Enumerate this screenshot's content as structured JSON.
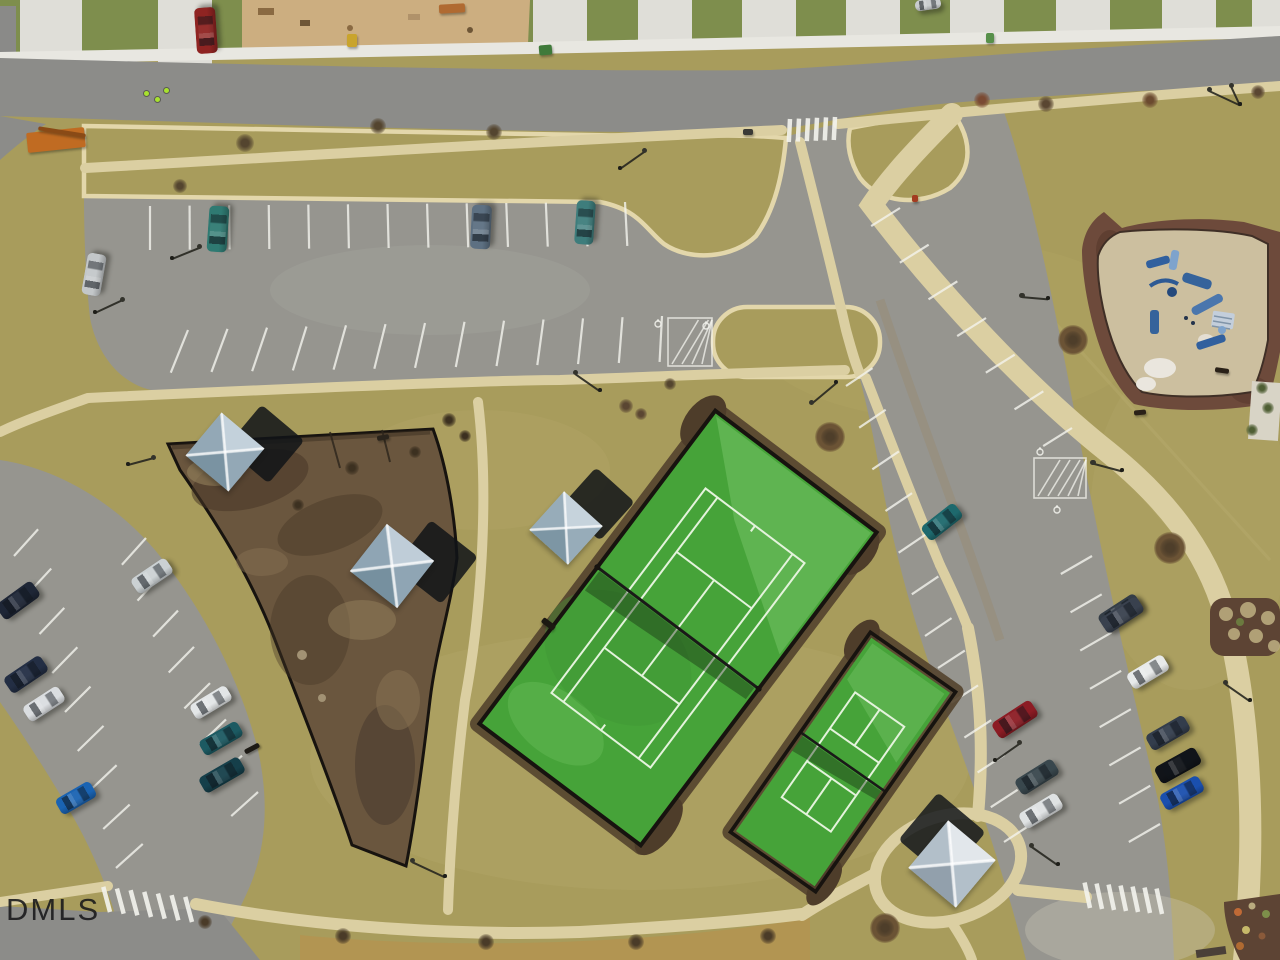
{
  "watermark": {
    "text": "DMLS"
  },
  "scene": {
    "type": "aerial-drone-photo",
    "description": "Overhead drone view of a suburban community amenity area: large fenced green tennis court and smaller pickleball court, brown mulched dog park with shade sails, playground with blue equipment, curving parking lots with cars, streets with crosswalks and a construction lot along the top.",
    "palette": {
      "grass": "#a89c5c",
      "lawn": "#7e8e4d",
      "asphalt": "#8c8c89",
      "parking": "#96958f",
      "walkway": "#dbcfa2",
      "curb": "#e3d7ab",
      "court_green": "#46a339",
      "court_line": "#e4f3dc",
      "fence": "#17130f",
      "dog_park_mulch": "#6a563e",
      "playground_mulch": "#6d4a3b",
      "playground_sand": "#ccbf9f",
      "stripe_white": "#f4f4ee"
    }
  },
  "objects": {
    "cars": [
      {
        "name": "red-pickup-truck",
        "x": 206,
        "y": 30,
        "w": 46,
        "h": 21,
        "rot": -94,
        "color": "#8f2422"
      },
      {
        "name": "silver-car",
        "x": 928,
        "y": 4,
        "w": 26,
        "h": 11,
        "rot": -8,
        "color": "#c9ccce"
      },
      {
        "name": "teal-white-pickup",
        "x": 218,
        "y": 229,
        "w": 46,
        "h": 20,
        "rot": -86,
        "color": "#2f7a72"
      },
      {
        "name": "slate-suv",
        "x": 481,
        "y": 227,
        "w": 44,
        "h": 20,
        "rot": -87,
        "color": "#5d7082"
      },
      {
        "name": "teal-car",
        "x": 585,
        "y": 222,
        "w": 44,
        "h": 19,
        "rot": -86,
        "color": "#3e7d7c"
      },
      {
        "name": "silver-car",
        "x": 94,
        "y": 274,
        "w": 42,
        "h": 19,
        "rot": -80,
        "color": "#c3c7c9"
      },
      {
        "name": "dark-navy-suv",
        "x": 18,
        "y": 600,
        "w": 44,
        "h": 19,
        "rot": -36,
        "color": "#1e2636"
      },
      {
        "name": "dark-blue-suv",
        "x": 26,
        "y": 674,
        "w": 44,
        "h": 19,
        "rot": -34,
        "color": "#232e44"
      },
      {
        "name": "white-sedan",
        "x": 44,
        "y": 704,
        "w": 42,
        "h": 18,
        "rot": -33,
        "color": "#dadde0"
      },
      {
        "name": "bright-blue-car",
        "x": 76,
        "y": 798,
        "w": 40,
        "h": 18,
        "rot": -30,
        "color": "#1a63b2"
      },
      {
        "name": "silver-car",
        "x": 152,
        "y": 576,
        "w": 42,
        "h": 18,
        "rot": -34,
        "color": "#cbd1d3"
      },
      {
        "name": "white-sedan",
        "x": 211,
        "y": 702,
        "w": 42,
        "h": 17,
        "rot": -31,
        "color": "#e3e6e7"
      },
      {
        "name": "dark-teal-car",
        "x": 221,
        "y": 738,
        "w": 44,
        "h": 17,
        "rot": -30,
        "color": "#1c5a62"
      },
      {
        "name": "dark-teal-suv",
        "x": 222,
        "y": 775,
        "w": 46,
        "h": 18,
        "rot": -30,
        "color": "#153f4a"
      },
      {
        "name": "teal-sedan",
        "x": 942,
        "y": 522,
        "w": 42,
        "h": 18,
        "rot": -38,
        "color": "#1e696d"
      },
      {
        "name": "gray-sedan",
        "x": 1120,
        "y": 612,
        "w": 44,
        "h": 18,
        "rot": -33,
        "color": "#343d47"
      },
      {
        "name": "dark-red-car",
        "x": 1015,
        "y": 719,
        "w": 46,
        "h": 19,
        "rot": -33,
        "color": "#8c1c24"
      },
      {
        "name": "gray-green-suv",
        "x": 1037,
        "y": 777,
        "w": 44,
        "h": 18,
        "rot": -32,
        "color": "#39474d"
      },
      {
        "name": "white-car",
        "x": 1041,
        "y": 811,
        "w": 44,
        "h": 18,
        "rot": -31,
        "color": "#dfe2e3"
      },
      {
        "name": "gray-car",
        "x": 1122,
        "y": 615,
        "w": 44,
        "h": 18,
        "rot": -33,
        "color": "#39414e"
      },
      {
        "name": "white-car",
        "x": 1148,
        "y": 672,
        "w": 42,
        "h": 18,
        "rot": -31,
        "color": "#e8eaea"
      },
      {
        "name": "slate-car",
        "x": 1168,
        "y": 733,
        "w": 44,
        "h": 18,
        "rot": -30,
        "color": "#333d4c"
      },
      {
        "name": "black-suv",
        "x": 1178,
        "y": 765,
        "w": 46,
        "h": 19,
        "rot": -29,
        "color": "#111419"
      },
      {
        "name": "blue-car",
        "x": 1182,
        "y": 793,
        "w": 44,
        "h": 18,
        "rot": -29,
        "color": "#1a4fae"
      }
    ],
    "shade_structures": [
      {
        "name": "dog-park-shade-sail",
        "x": 225,
        "y": 452,
        "size": 56,
        "rot": 40,
        "light": "#c3d1db",
        "mid": "#93a8b6",
        "dark": "#7a93a2",
        "shadow": {
          "dx": 40,
          "dy": -8,
          "color": "#101418"
        }
      },
      {
        "name": "dog-park-shade-sail",
        "x": 392,
        "y": 566,
        "size": 60,
        "rot": 38,
        "light": "#bfcdd8",
        "mid": "#8fa5b4",
        "dark": "#76909f",
        "shadow": {
          "dx": 44,
          "dy": -4,
          "color": "#101418"
        }
      },
      {
        "name": "tennis-court-shade-sail",
        "x": 566,
        "y": 528,
        "size": 52,
        "rot": 42,
        "light": "#c6d3dc",
        "mid": "#97acb9",
        "dark": "#7d96a4",
        "shadow": {
          "dx": 32,
          "dy": -24,
          "color": "#101418"
        }
      },
      {
        "name": "picnic-shade-sail",
        "x": 952,
        "y": 864,
        "size": 62,
        "rot": 40,
        "light": "#e2e7eb",
        "mid": "#b2bfc9",
        "dark": "#92a0ac",
        "shadow": {
          "dx": -10,
          "dy": -28,
          "color": "#14181c"
        }
      }
    ],
    "street_lamps": [
      {
        "x": 95,
        "y": 312,
        "angle": -25,
        "len": 30
      },
      {
        "x": 172,
        "y": 258,
        "angle": -22,
        "len": 30
      },
      {
        "x": 620,
        "y": 168,
        "angle": -35,
        "len": 30
      },
      {
        "x": 600,
        "y": 390,
        "angle": 215,
        "len": 30
      },
      {
        "x": 836,
        "y": 382,
        "angle": 140,
        "len": 32
      },
      {
        "x": 445,
        "y": 876,
        "angle": 205,
        "len": 36
      },
      {
        "x": 1240,
        "y": 104,
        "angle": 205,
        "len": 34
      },
      {
        "x": 1240,
        "y": 104,
        "angle": 245,
        "len": 20
      },
      {
        "x": 1048,
        "y": 298,
        "angle": 185,
        "len": 26
      },
      {
        "x": 1122,
        "y": 470,
        "angle": 195,
        "len": 30
      },
      {
        "x": 995,
        "y": 760,
        "angle": -35,
        "len": 30
      },
      {
        "x": 1058,
        "y": 864,
        "angle": 215,
        "len": 32
      },
      {
        "x": 128,
        "y": 464,
        "angle": -15,
        "len": 26
      },
      {
        "x": 1250,
        "y": 700,
        "angle": 215,
        "len": 30
      }
    ],
    "trees": [
      {
        "x": 245,
        "y": 143,
        "r": 9,
        "c": "#54452f"
      },
      {
        "x": 378,
        "y": 126,
        "r": 8,
        "c": "#54452f"
      },
      {
        "x": 494,
        "y": 132,
        "r": 8,
        "c": "#54452f"
      },
      {
        "x": 180,
        "y": 186,
        "r": 7,
        "c": "#54452f"
      },
      {
        "x": 982,
        "y": 100,
        "r": 8,
        "c": "#7a4a33"
      },
      {
        "x": 1046,
        "y": 104,
        "r": 8,
        "c": "#5a4632"
      },
      {
        "x": 1150,
        "y": 100,
        "r": 8,
        "c": "#6b4a2f"
      },
      {
        "x": 1258,
        "y": 92,
        "r": 7,
        "c": "#5a4632"
      },
      {
        "x": 626,
        "y": 406,
        "r": 7,
        "c": "#5a4632"
      },
      {
        "x": 641,
        "y": 414,
        "r": 6,
        "c": "#5a4632"
      },
      {
        "x": 830,
        "y": 437,
        "r": 9,
        "c": "#4e3e2a",
        "ring": 1
      },
      {
        "x": 1073,
        "y": 340,
        "r": 9,
        "c": "#4e3e2a",
        "ring": 1
      },
      {
        "x": 1170,
        "y": 548,
        "r": 10,
        "c": "#4e3e2a",
        "ring": 1
      },
      {
        "x": 885,
        "y": 928,
        "r": 9,
        "c": "#4e3e2a",
        "ring": 1
      },
      {
        "x": 343,
        "y": 936,
        "r": 8,
        "c": "#4a3b28"
      },
      {
        "x": 486,
        "y": 942,
        "r": 8,
        "c": "#4a3b28"
      },
      {
        "x": 636,
        "y": 942,
        "r": 8,
        "c": "#4a3b28"
      },
      {
        "x": 768,
        "y": 936,
        "r": 8,
        "c": "#4a3b28"
      },
      {
        "x": 449,
        "y": 420,
        "r": 7,
        "c": "#3c3020"
      },
      {
        "x": 465,
        "y": 436,
        "r": 6,
        "c": "#3c3020"
      },
      {
        "x": 670,
        "y": 384,
        "r": 6,
        "c": "#54452f"
      },
      {
        "x": 1262,
        "y": 388,
        "r": 6,
        "c": "#4e5e33"
      },
      {
        "x": 1268,
        "y": 408,
        "r": 6,
        "c": "#4e5e33"
      },
      {
        "x": 1252,
        "y": 430,
        "r": 6,
        "c": "#4e5e33"
      },
      {
        "x": 352,
        "y": 468,
        "r": 7,
        "c": "#3c3020"
      },
      {
        "x": 298,
        "y": 505,
        "r": 6,
        "c": "#3c3020"
      },
      {
        "x": 415,
        "y": 452,
        "r": 6,
        "c": "#3c3020"
      },
      {
        "x": 205,
        "y": 922,
        "r": 7,
        "c": "#4a3b28"
      }
    ],
    "site_marks": [
      {
        "name": "bench",
        "x": 252,
        "y": 748,
        "w": 16,
        "h": 5,
        "rot": -28,
        "color": "#1d1a15"
      },
      {
        "name": "bench",
        "x": 1222,
        "y": 370,
        "w": 14,
        "h": 5,
        "rot": 8,
        "color": "#2a2118"
      },
      {
        "name": "bench",
        "x": 1140,
        "y": 412,
        "w": 12,
        "h": 5,
        "rot": -5,
        "color": "#2a2118"
      },
      {
        "name": "dog-park-gate",
        "x": 383,
        "y": 437,
        "w": 12,
        "h": 5,
        "rot": -10,
        "color": "#2a241c"
      },
      {
        "name": "court-gate",
        "x": 548,
        "y": 624,
        "w": 15,
        "h": 6,
        "rot": 37,
        "color": "#1c1812"
      },
      {
        "name": "porta-potty",
        "x": 352,
        "y": 40,
        "w": 10,
        "h": 13,
        "rot": 0,
        "color": "#c9a42c"
      },
      {
        "name": "dumpster",
        "x": 545,
        "y": 50,
        "w": 13,
        "h": 10,
        "rot": -5,
        "color": "#3f7a3a"
      },
      {
        "name": "bin",
        "x": 990,
        "y": 38,
        "w": 8,
        "h": 10,
        "rot": 0,
        "color": "#57904a"
      },
      {
        "name": "lumber-pile",
        "x": 452,
        "y": 8,
        "w": 26,
        "h": 9,
        "rot": -3,
        "color": "#b06a31"
      },
      {
        "name": "telehandler",
        "x": 56,
        "y": 140,
        "w": 58,
        "h": 20,
        "rot": -6,
        "color": "#c06b22"
      },
      {
        "name": "telehandler-boom",
        "x": 62,
        "y": 132,
        "w": 48,
        "h": 4,
        "rot": 9,
        "color": "#8a4a16"
      },
      {
        "name": "storm-drain",
        "x": 748,
        "y": 132,
        "w": 10,
        "h": 6,
        "rot": 0,
        "color": "#3a3a36"
      },
      {
        "name": "fire-hydrant",
        "x": 915,
        "y": 198,
        "w": 6,
        "h": 7,
        "rot": 0,
        "color": "#a33b20"
      }
    ],
    "workers": [
      {
        "x": 146,
        "y": 93
      },
      {
        "x": 157,
        "y": 99
      },
      {
        "x": 166,
        "y": 90
      }
    ]
  },
  "road_markings": {
    "stripe_rows": [
      {
        "x1": 150,
        "y1": 206,
        "x2": 625,
        "y2": 202,
        "count": 13,
        "len": 44,
        "a1": 90,
        "a2": 87
      },
      {
        "x1": 188,
        "y1": 330,
        "x2": 662,
        "y2": 316,
        "count": 13,
        "len": 46,
        "a1": 112,
        "a2": 93
      },
      {
        "x1": 900,
        "y1": 208,
        "x2": 1072,
        "y2": 428,
        "count": 7,
        "len": 34,
        "a1": 148,
        "a2": 148
      },
      {
        "x1": 1092,
        "y1": 556,
        "x2": 1160,
        "y2": 824,
        "count": 8,
        "len": 36,
        "a1": 150,
        "a2": 150
      },
      {
        "x1": 846,
        "y1": 386,
        "x2": 925,
        "y2": 636,
        "count": 7,
        "len": 32,
        "a1": -34,
        "a2": -34
      },
      {
        "x1": 938,
        "y1": 668,
        "x2": 1004,
        "y2": 842,
        "count": 6,
        "len": 32,
        "a1": -33,
        "a2": -33
      },
      {
        "x1": 14,
        "y1": 556,
        "x2": 116,
        "y2": 868,
        "count": 9,
        "len": 36,
        "a1": -48,
        "a2": -42
      },
      {
        "x1": 146,
        "y1": 538,
        "x2": 258,
        "y2": 792,
        "count": 8,
        "len": 36,
        "a1": 132,
        "a2": 138
      }
    ],
    "crosswalks": [
      {
        "x1": 790,
        "y1": 119,
        "x2": 835,
        "y2": 117,
        "count": 6,
        "len": 23,
        "angle": 93
      },
      {
        "x1": 110,
        "y1": 912,
        "x2": 192,
        "y2": 922,
        "count": 7,
        "len": 26,
        "angle": -105
      },
      {
        "x1": 1090,
        "y1": 908,
        "x2": 1162,
        "y2": 914,
        "count": 7,
        "len": 26,
        "angle": -102
      }
    ],
    "hatches": [
      {
        "x": 668,
        "y": 318,
        "w": 44,
        "h": 48
      },
      {
        "x": 1034,
        "y": 458,
        "w": 52,
        "h": 40
      }
    ],
    "access_symbols": [
      {
        "x": 658,
        "y": 324
      },
      {
        "x": 706,
        "y": 326
      },
      {
        "x": 1040,
        "y": 452
      },
      {
        "x": 1057,
        "y": 510
      }
    ]
  }
}
